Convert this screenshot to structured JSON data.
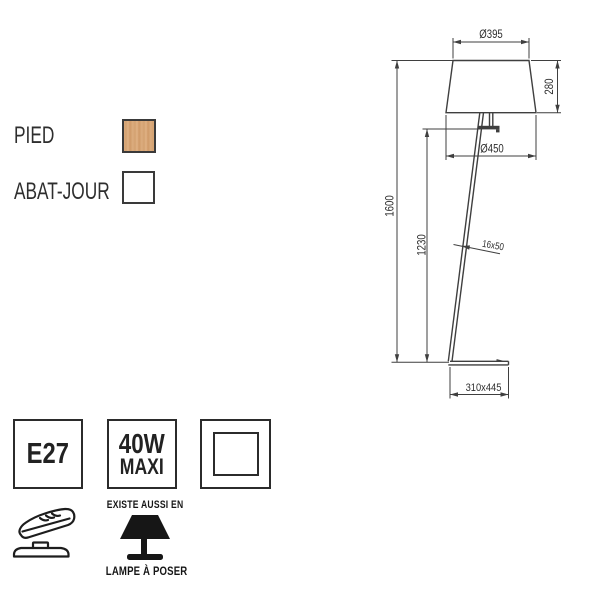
{
  "colors": {
    "wood_swatch": "#d8a878",
    "shade_swatch": "#ffffff",
    "drawing_line": "#3f3f3f",
    "ink": "#1d1d1d"
  },
  "materials": {
    "pied": {
      "label": "PIED"
    },
    "abat_jour": {
      "label": "ABAT-JOUR"
    }
  },
  "drawing": {
    "dimensions": {
      "shade_top_diameter": "Ø395",
      "shade_height": "280",
      "shade_bottom_diameter": "Ø450",
      "total_height": "1600",
      "pole_height": "1230",
      "pole_section": "16x50",
      "base_size": "310x445"
    }
  },
  "specs": {
    "socket": "E27",
    "max_wattage": {
      "line1": "40W",
      "line2": "MAXI"
    }
  },
  "footer": {
    "also_available_title": "EXISTE AUSSI EN",
    "also_available_item": "LAMPE À POSER"
  }
}
